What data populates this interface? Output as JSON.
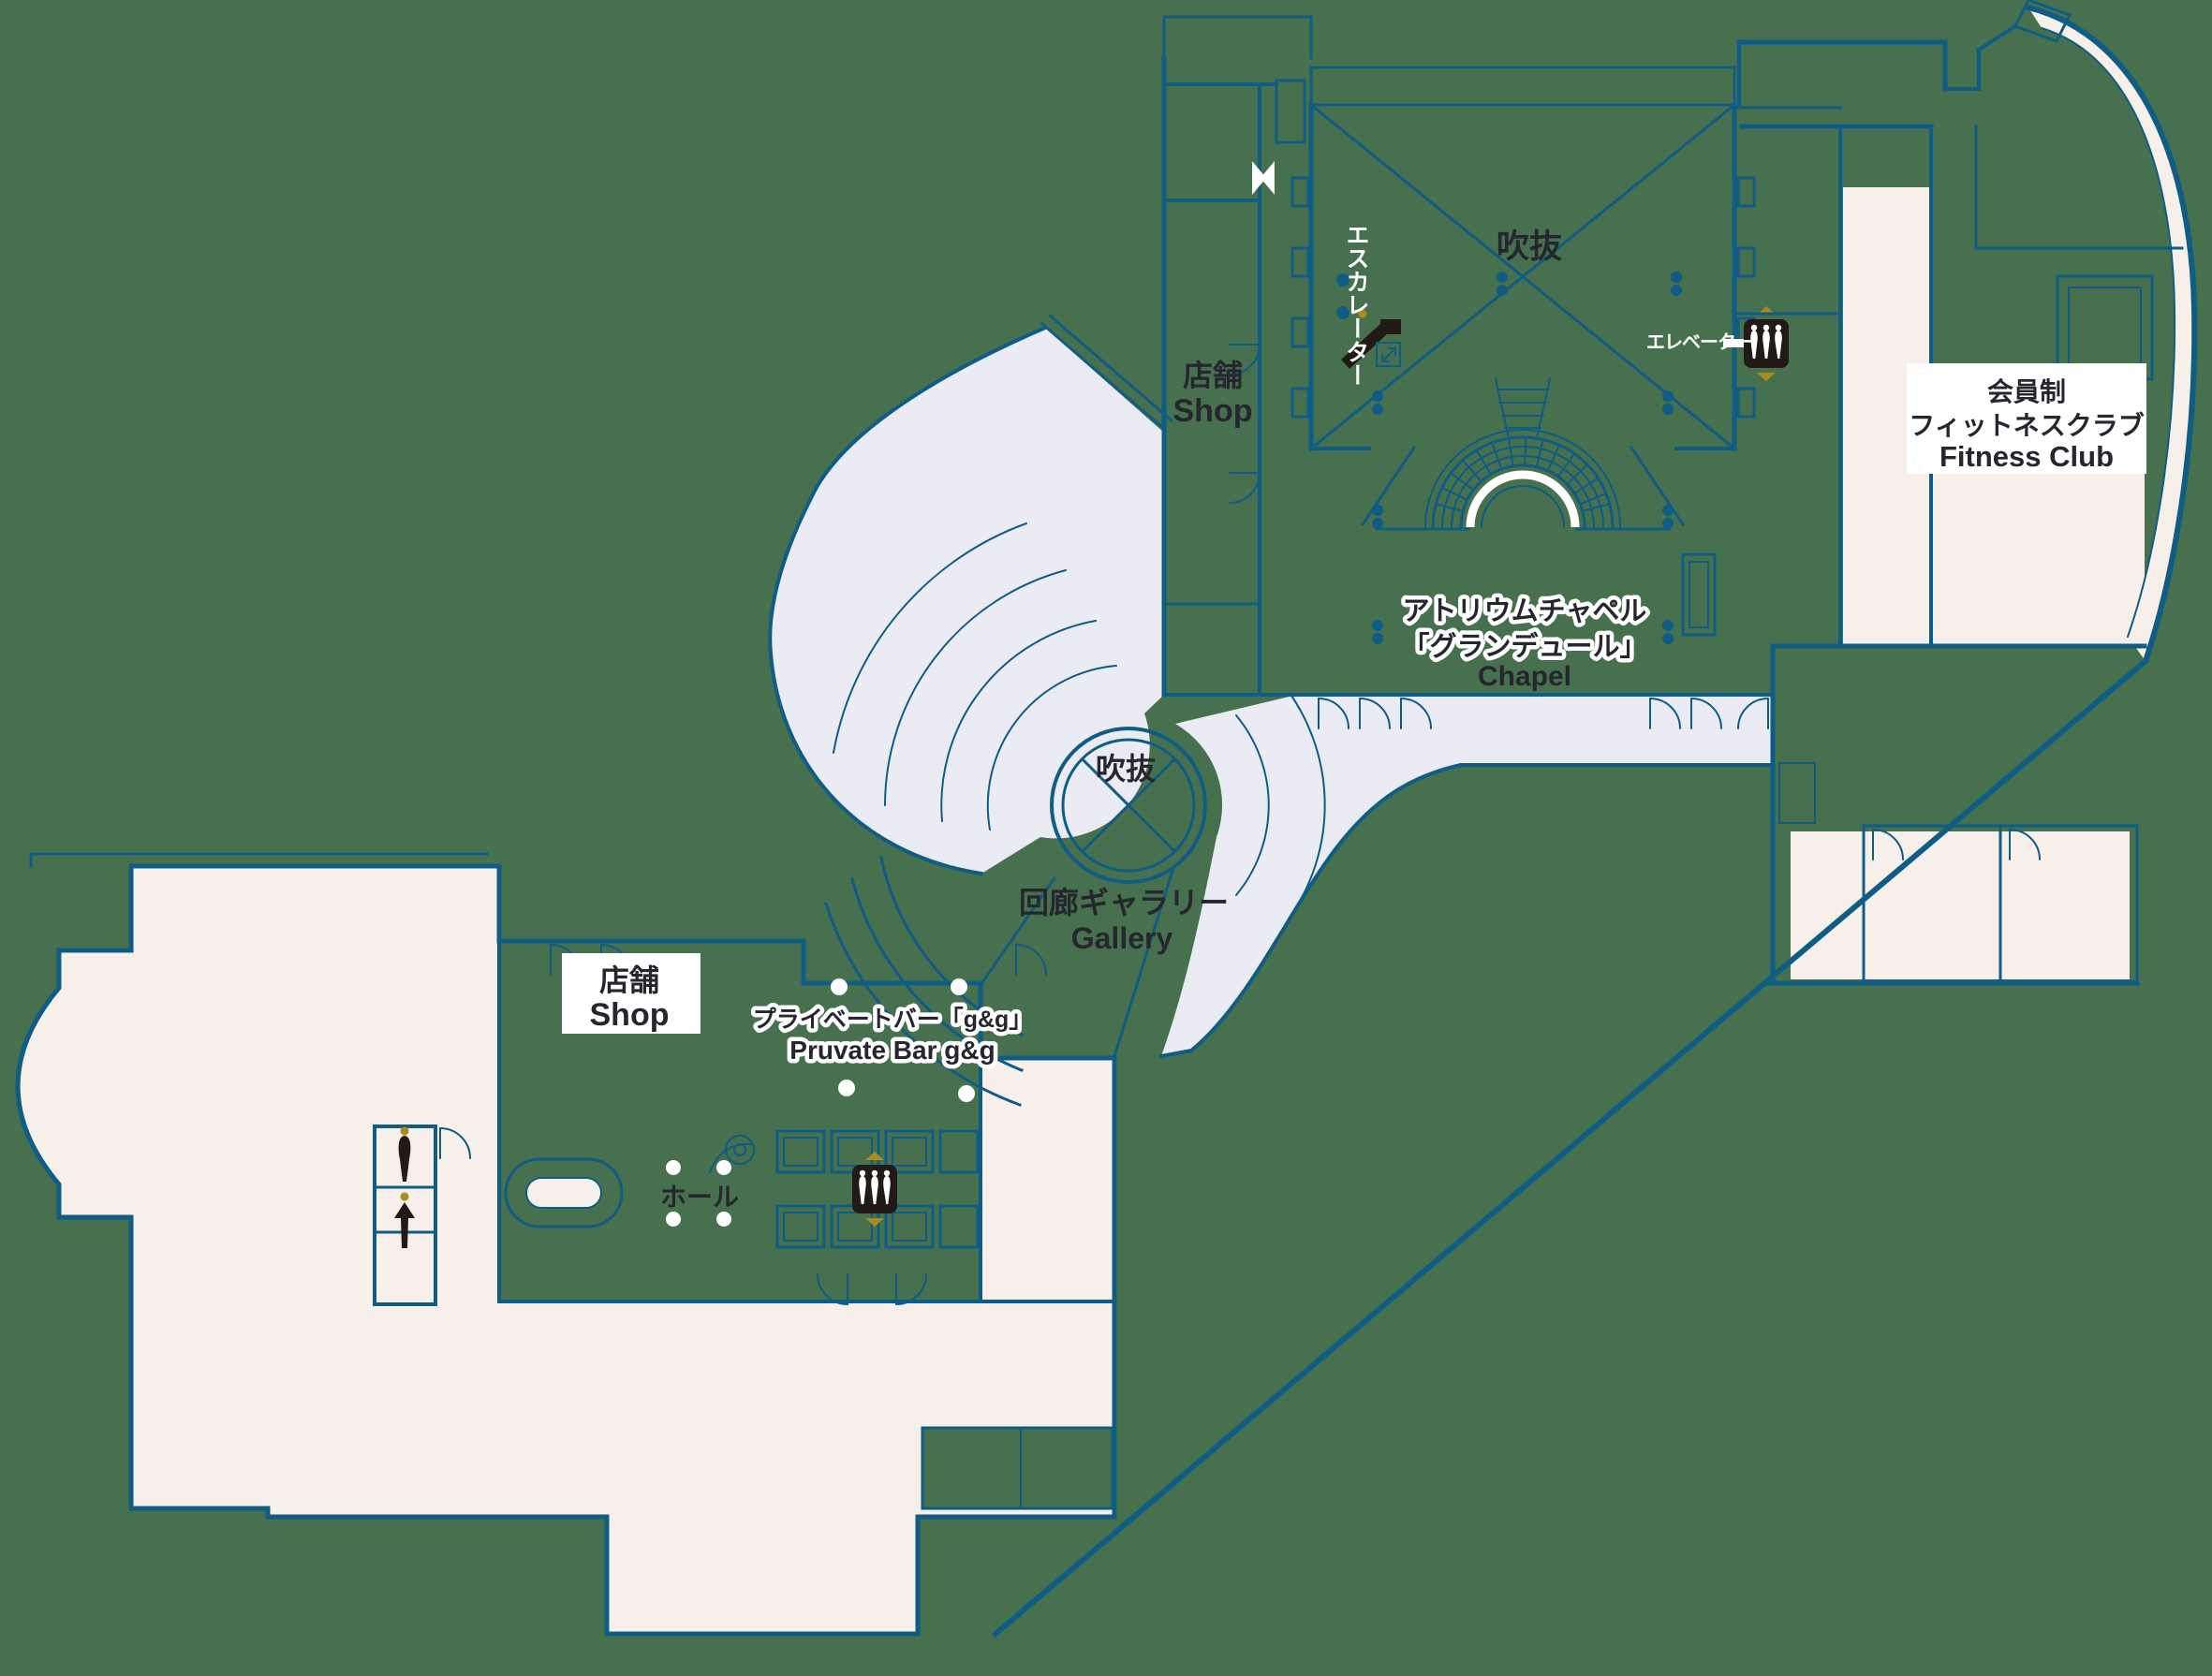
{
  "map": {
    "kind": "hotel-floor-plan",
    "colors": {
      "background_green": "#47704F",
      "wall_blue": "#0F5C85",
      "room_beige": "#F7EFEA",
      "corridor_lavender": "#EBEBF4",
      "label_dark": "#26262E",
      "label_white": "#FFFFFF",
      "accent_gold": "#AD8A1D",
      "icon_black": "#221A16"
    }
  },
  "areas": {
    "atrium_upper": {
      "label": "吹抜"
    },
    "shop_upper": {
      "label_ja": "店舗",
      "label_en": "Shop"
    },
    "escalator": {
      "label": "エスカレーター"
    },
    "elevator_upper": {
      "label": "エレベーター"
    },
    "fitness_club": {
      "label_line1": "会員制",
      "label_line2": "フィットネスクラブ",
      "label_line3": "Fitness Club"
    },
    "chapel": {
      "label_line1": "アトリウムチャペル",
      "label_line2": "「グランデュール」",
      "label_line3": "Chapel"
    },
    "atrium_center": {
      "label": "吹抜"
    },
    "gallery": {
      "label_ja": "回廊ギャラリー",
      "label_en": "Gallery"
    },
    "shop_lower": {
      "label_ja": "店舗",
      "label_en": "Shop"
    },
    "private_bar": {
      "label_ja": "プライベートバー「g&g」",
      "label_en": "Pruvate Bar g&g"
    },
    "hall": {
      "label": "ホール"
    }
  },
  "icons": {
    "escalator": "escalator-icon",
    "elevator_group": "elevator-icon (3 cabs, up/down gold arrows)",
    "elevator_down": "elevator-down-icon",
    "elevator_up": "elevator-up-icon"
  }
}
